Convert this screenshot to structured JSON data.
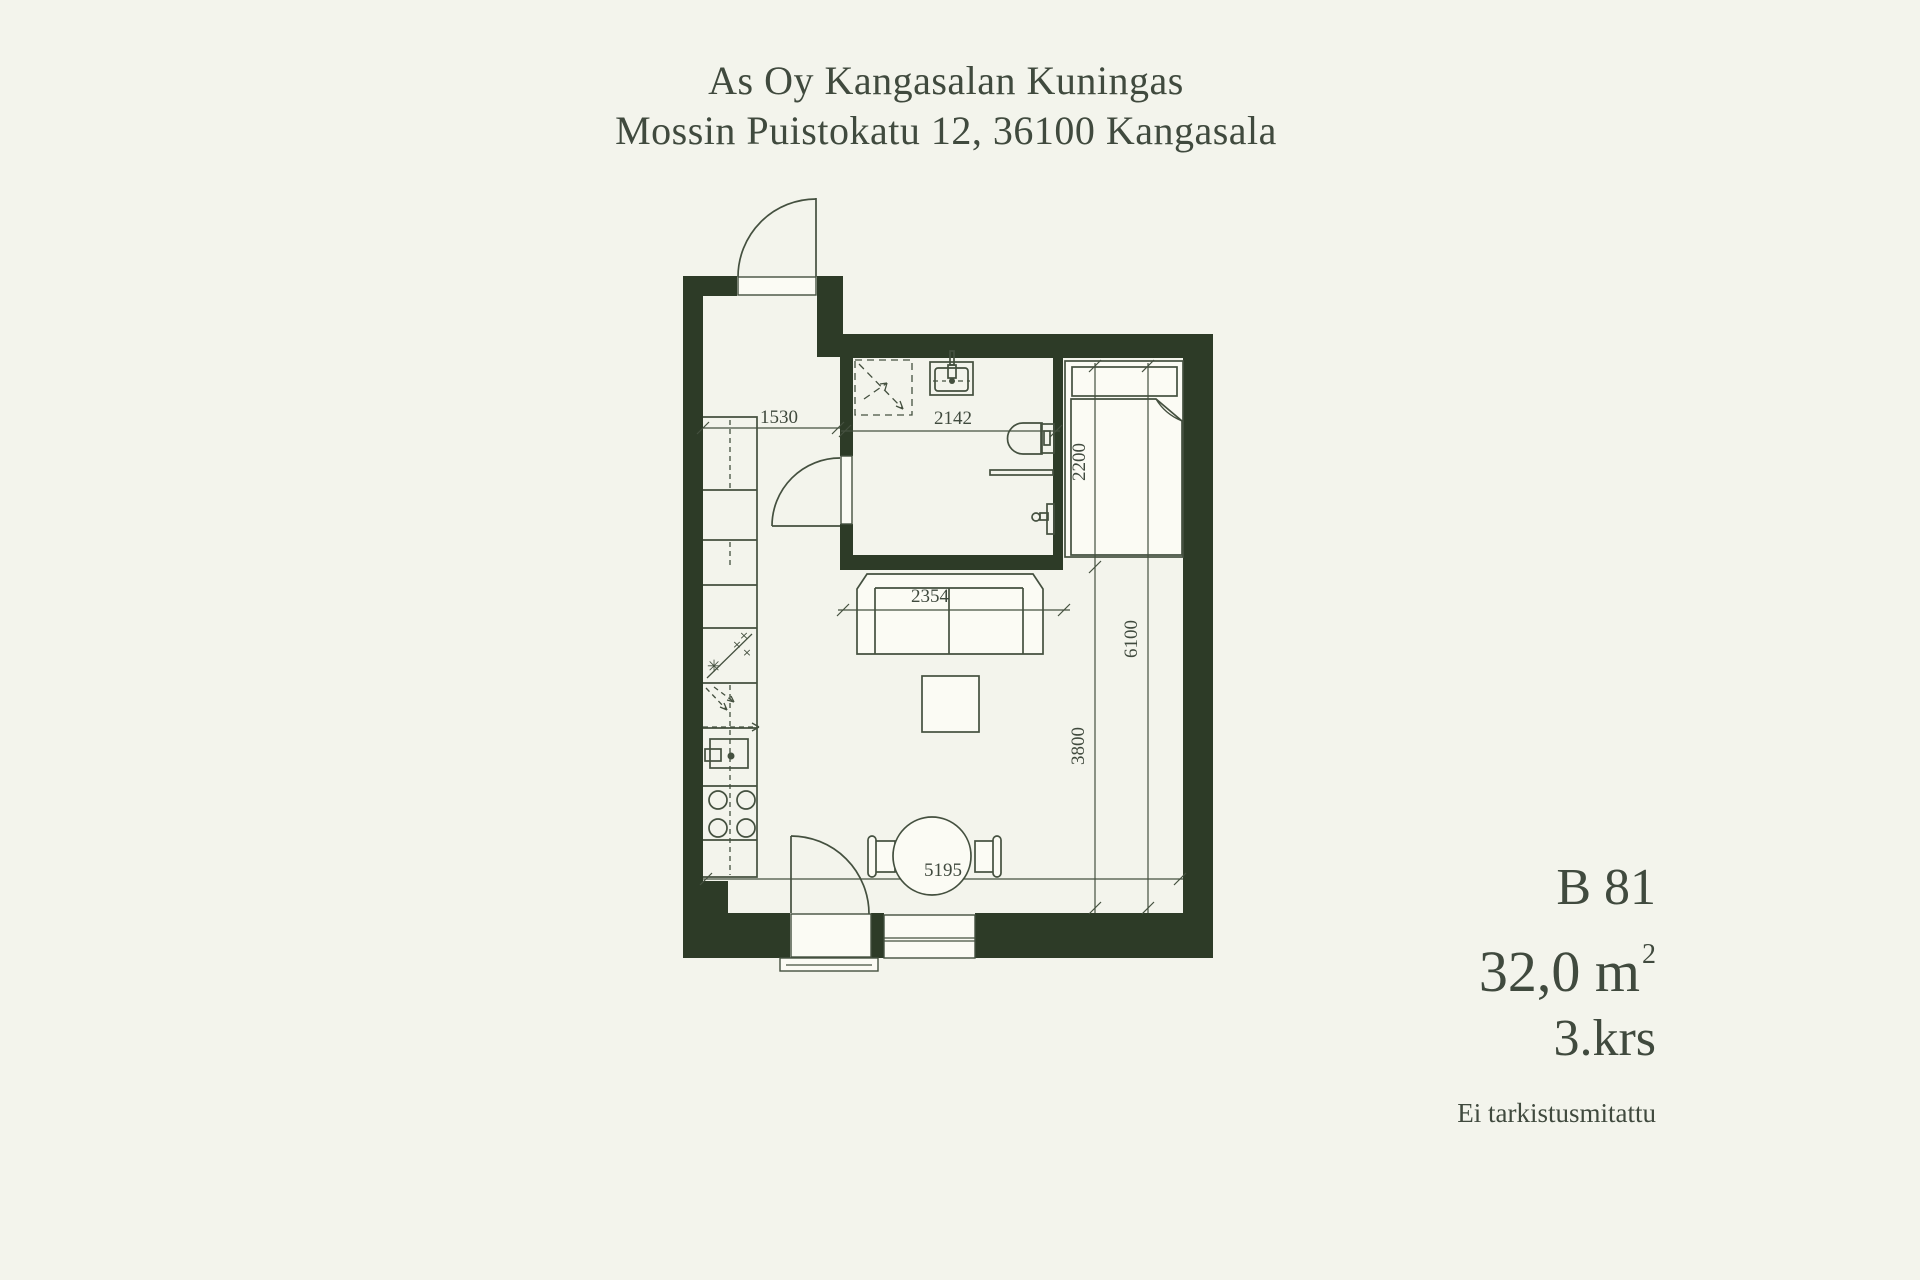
{
  "header": {
    "line1": "As Oy Kangasalan Kuningas",
    "line2": "Mossin Puistokatu 12, 36100 Kangasala"
  },
  "unit": {
    "id": "B 81",
    "area": "32,0 m",
    "area_sup": "2",
    "floor": "3.krs",
    "note": "Ei tarkistusmitattu"
  },
  "dims": {
    "hallway": "1530",
    "bathroom": "2142",
    "bed": "2200",
    "sofa": "2354",
    "living": "3800",
    "depth": "6100",
    "width": "5195"
  },
  "symbols": {
    "freezer_star": "✳",
    "cross": "×"
  },
  "colors": {
    "background": "#f3f4ec",
    "wall": "#2d3b27",
    "line": "#44503f",
    "text": "#404a3e",
    "furniture": "#fbfbf4"
  }
}
